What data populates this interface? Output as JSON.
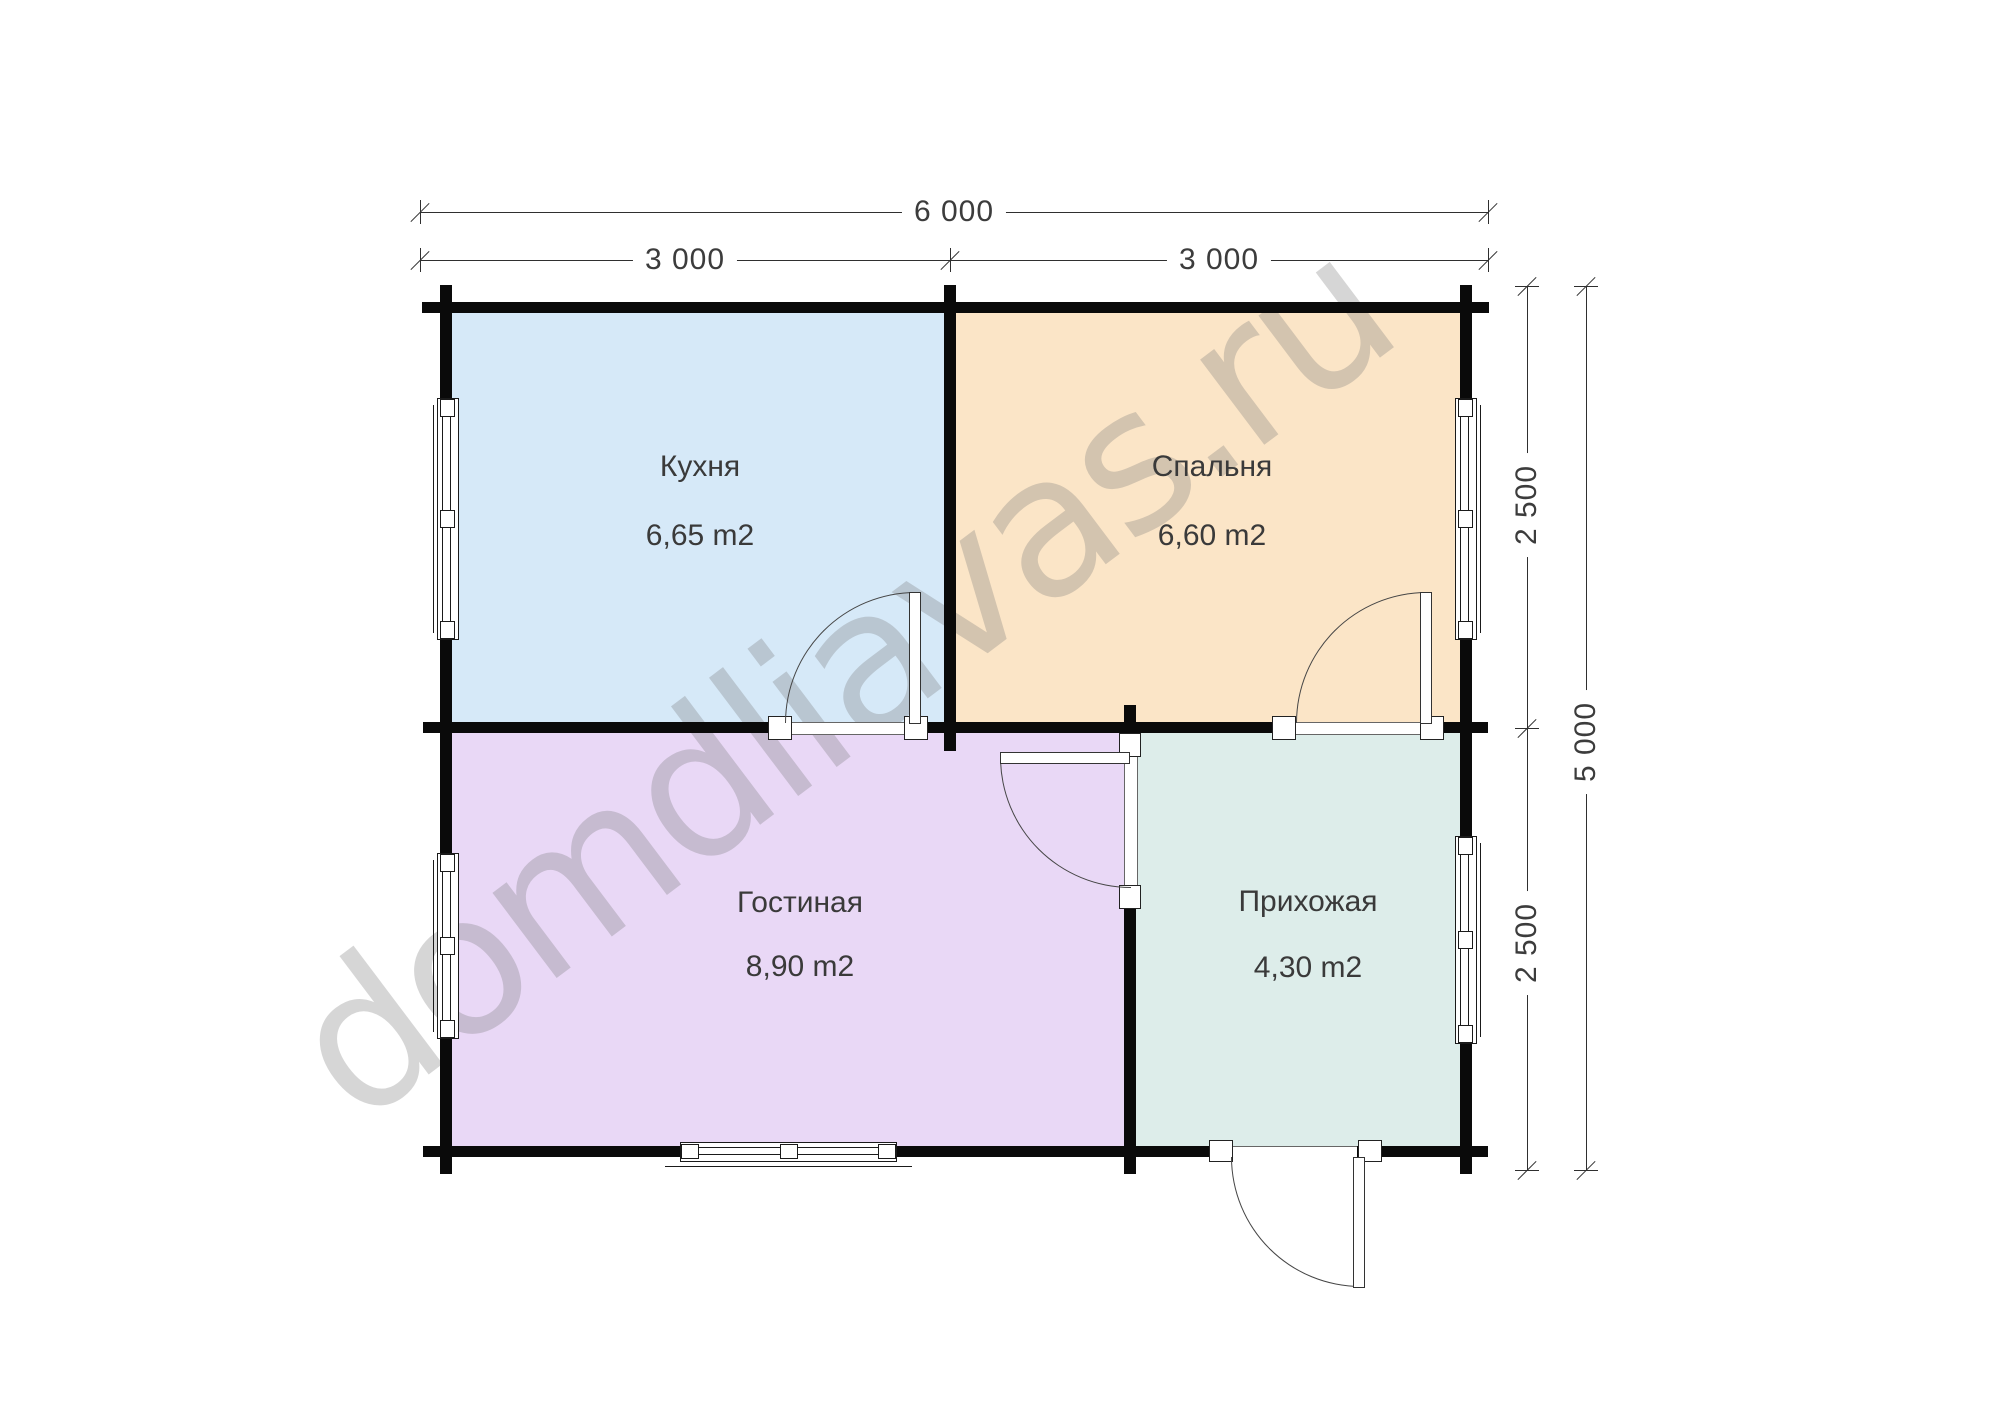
{
  "watermark": {
    "text": "domdliavas.ru",
    "color": "#787878"
  },
  "dimensions": {
    "top_total": "6 000",
    "top_left_half": "3 000",
    "top_right_half": "3 000",
    "right_upper": "2 500",
    "right_lower": "2 500",
    "right_total": "5 000"
  },
  "rooms": [
    {
      "name": "Кухня",
      "area": "6,65 m2",
      "color": "#d6e9f8"
    },
    {
      "name": "Спальня",
      "area": "6,60 m2",
      "color": "#fbe5c7"
    },
    {
      "name": "Гостиная",
      "area": "8,90 m2",
      "color": "#e9d8f6"
    },
    {
      "name": "Прихожая",
      "area": "4,30 m2",
      "color": "#ddedea"
    }
  ]
}
